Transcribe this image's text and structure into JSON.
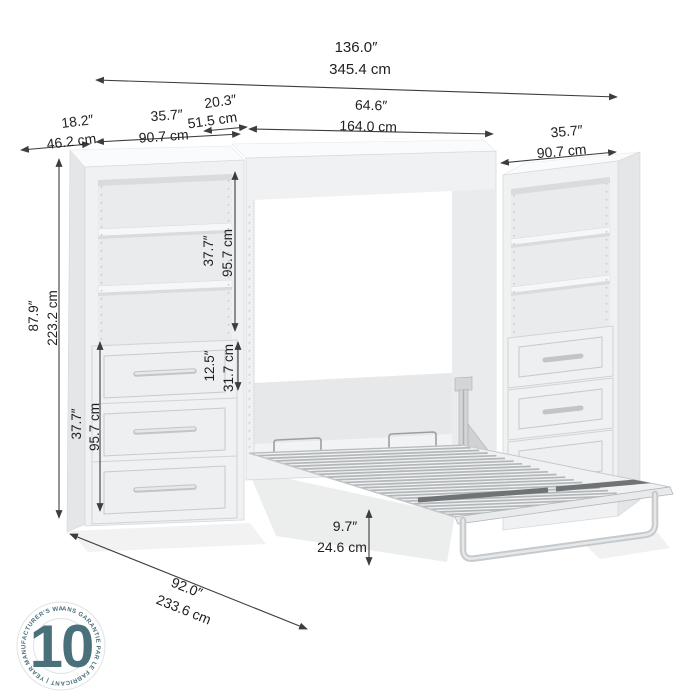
{
  "dimensions": {
    "overall_width": {
      "in": "136.0″",
      "cm": "345.4 cm"
    },
    "side_unit_depth": {
      "in": "18.2″",
      "cm": "46.2 cm"
    },
    "left_unit_width": {
      "in": "35.7″",
      "cm": "90.7 cm"
    },
    "bed_cabinet_depth": {
      "in": "20.3″",
      "cm": "51.5 cm"
    },
    "bed_cabinet_width": {
      "in": "64.6″",
      "cm": "164.0 cm"
    },
    "right_unit_width": {
      "in": "35.7″",
      "cm": "90.7 cm"
    },
    "total_height": {
      "in": "87.9″",
      "cm": "223.2 cm"
    },
    "shelf_section_height": {
      "in": "37.7″",
      "cm": "95.7 cm"
    },
    "drawer_height": {
      "in": "12.5″",
      "cm": "31.7 cm"
    },
    "drawer_section_height": {
      "in": "37.7″",
      "cm": "95.7 cm"
    },
    "open_bed_depth": {
      "in": "92.0″",
      "cm": "233.6 cm"
    },
    "bed_frame_height": {
      "in": "9.7″",
      "cm": "24.6 cm"
    }
  },
  "badge": {
    "number": "10",
    "ring_text": "ANS GARANTIE PAR LE FABRICANT  |  YEAR MANUFACTURER'S WARRANTY  |",
    "color": "#4a707c"
  }
}
